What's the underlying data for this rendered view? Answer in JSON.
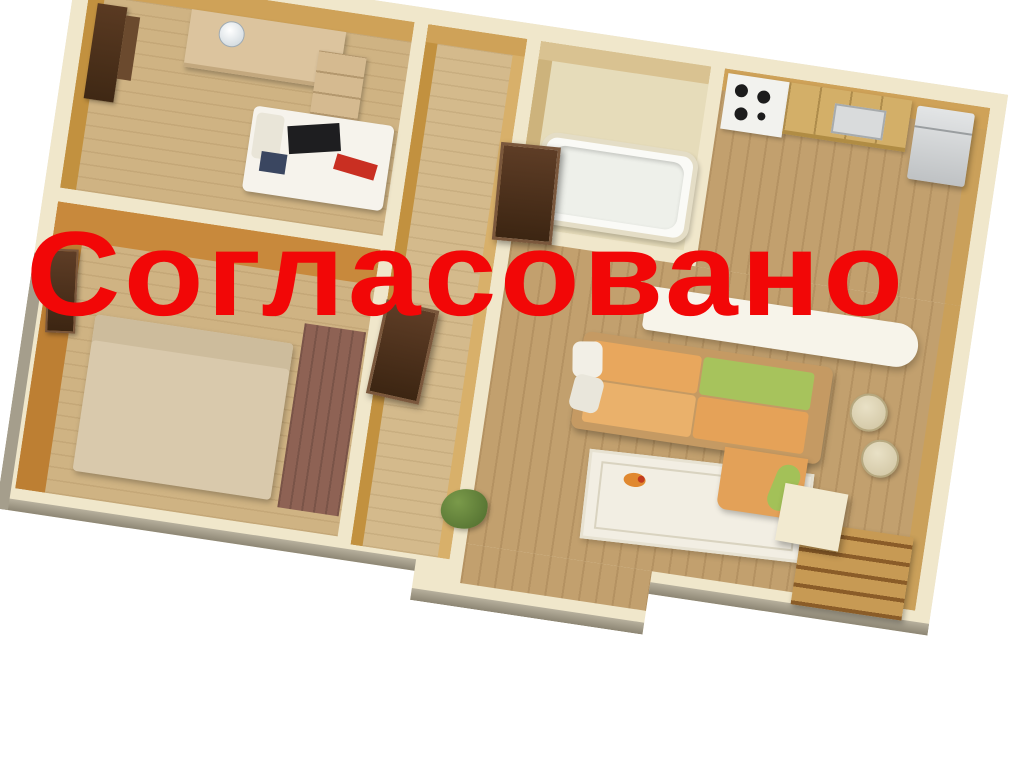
{
  "stamp": {
    "text": "Согласовано"
  },
  "scene": {
    "type": "3d-apartment-floor-plan-render",
    "rooms": [
      {
        "name": "study-bedroom",
        "furniture": [
          "wardrobe",
          "desk",
          "desk-lamp",
          "drawer-unit",
          "single-bed"
        ]
      },
      {
        "name": "bedroom",
        "furniture": [
          "door",
          "double-bed",
          "rug"
        ]
      },
      {
        "name": "hallway",
        "furniture": [
          "entry-door",
          "interior-door"
        ]
      },
      {
        "name": "bathroom",
        "furniture": [
          "bathtub"
        ]
      },
      {
        "name": "kitchen",
        "furniture": [
          "stove",
          "cabinets",
          "microwave",
          "refrigerator"
        ]
      },
      {
        "name": "living-room",
        "furniture": [
          "bar-counter",
          "sofa",
          "chaise",
          "area-rug",
          "bar-stools",
          "plant",
          "stairs"
        ]
      }
    ]
  },
  "colors": {
    "stamp_red": "#f20707",
    "wall_cream": "#f0e7cb",
    "inner_tan": "#cfa258",
    "inner_orange": "#c8893c",
    "floor_light": "#cfb383",
    "floor_living": "#c2a06e",
    "floor_bath": "#e6dcba",
    "bed_beige": "#d9c9ac",
    "mattress_white": "#f6f3ec",
    "rug_brown": "#8e6254",
    "rug_white": "#f2eee3",
    "sofa_orange": "#e8a75d",
    "sofa_green": "#a7c35c",
    "counter_white": "#f7f4ea",
    "cabinet_wood": "#d3af68"
  }
}
